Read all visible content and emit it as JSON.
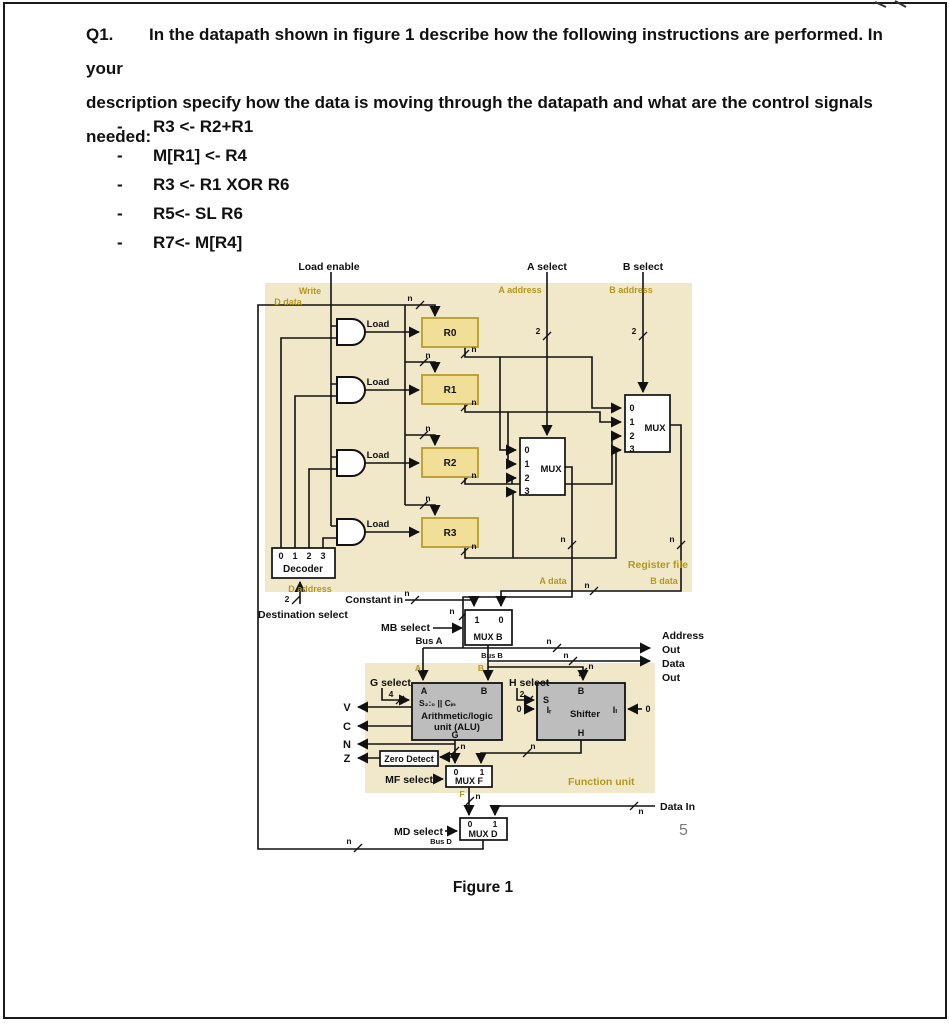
{
  "page": {
    "question": {
      "label": "Q1.",
      "lines": [
        "In the datapath shown in figure 1 describe how the following instructions are performed. In your",
        "description specify how the data is moving through the datapath and what are the control signals",
        "needed:"
      ],
      "bullet": "-",
      "instructions": [
        "R3 <- R2+R1",
        "M[R1] <- R4",
        "R3 <- R1 XOR R6",
        "R5<- SL R6",
        "R7<- M[R4]"
      ]
    },
    "figure_caption": "Figure 1",
    "page_number": "5"
  },
  "colors": {
    "register_file_bg": "#f1e8ca",
    "function_unit_bg": "#f1e8ca",
    "register_fill": "#f2df97",
    "register_border": "#b89b2b",
    "unit_fill": "#bdbdbd",
    "olive_label": "#b3981d",
    "wire": "#111111"
  },
  "d": {
    "load_enable": "Load enable",
    "a_select": "A select",
    "b_select": "B select",
    "write": "Write",
    "d_data": "D data",
    "a_address": "A address",
    "b_address": "B address",
    "load": "Load",
    "r0": "R0",
    "r1": "R1",
    "r2": "R2",
    "r3": "R3",
    "n": "n",
    "n0": "0",
    "n1": "1",
    "n2": "2",
    "n3": "3",
    "n4": "4",
    "mux": "MUX",
    "decoder": "Decoder",
    "d_address": "D address",
    "destination_select": "Destination select",
    "constant_in": "Constant in",
    "mb_select": "MB select",
    "mux_b": "MUX B",
    "bus_a": "Bus A",
    "bus_b": "Bus B",
    "bus_d": "Bus D",
    "a_data": "A data",
    "b_data": "B data",
    "register_file": "Register file",
    "address": "Address",
    "out": "Out",
    "data": "Data",
    "g_select": "G select",
    "h_select": "H select",
    "a": "A",
    "b": "B",
    "s_line": "S₂:₀ || Cᵢₙ",
    "alu_line1": "Arithmetic/logic",
    "alu_line2": "unit (ALU)",
    "g": "G",
    "h": "H",
    "s": "S",
    "f": "F",
    "v": "V",
    "c": "C",
    "n_flag": "N",
    "z": "Z",
    "zero_detect": "Zero Detect",
    "shifter": "Shifter",
    "i_r": "Iᵣ",
    "i_l": "Iₗ",
    "mf_select": "MF select",
    "mux_f": "MUX F",
    "function_unit": "Function unit",
    "data_in": "Data In",
    "md_select": "MD select",
    "mux_d": "MUX D"
  }
}
